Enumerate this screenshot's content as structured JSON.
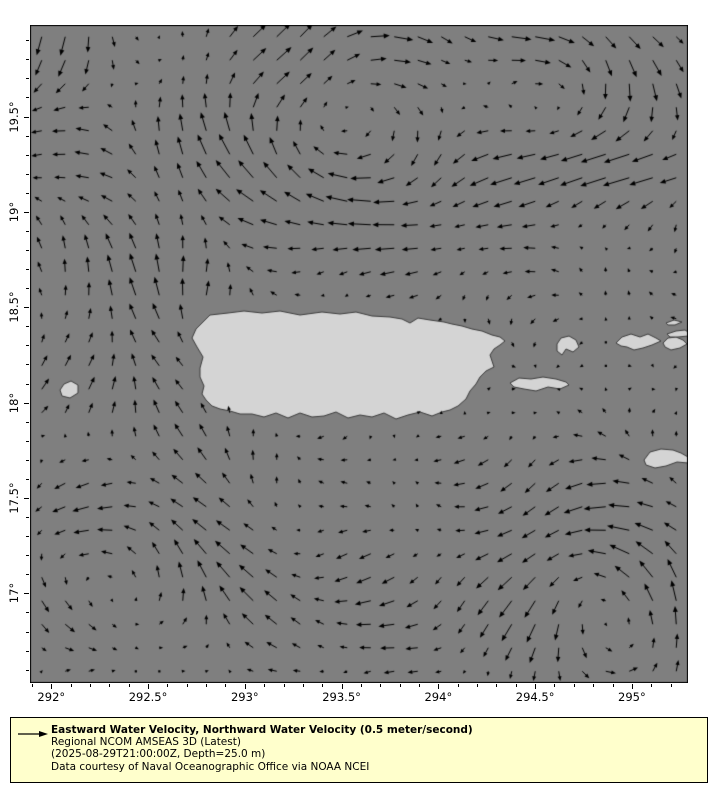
{
  "figure": {
    "width": 720,
    "height": 800,
    "background": "#ffffff"
  },
  "map": {
    "ocean_color": "#7f7f7f",
    "land_color": "#d4d4d4",
    "coast_color": "#3c3c3c",
    "arrow_color": "#000000",
    "frame_color": "#000000",
    "frame": {
      "left": 30,
      "top": 25,
      "width": 658,
      "height": 658
    },
    "lon_min": 291.89,
    "lon_max": 295.29,
    "lat_min": 16.53,
    "lat_max": 19.98,
    "islands": [
      {
        "name": "puerto-rico",
        "px": [
          [
            192,
            338
          ],
          [
            196,
            329
          ],
          [
            210,
            315
          ],
          [
            228,
            313
          ],
          [
            244,
            311
          ],
          [
            262,
            313
          ],
          [
            280,
            311
          ],
          [
            300,
            315
          ],
          [
            322,
            312
          ],
          [
            340,
            314
          ],
          [
            356,
            312
          ],
          [
            372,
            316
          ],
          [
            390,
            317
          ],
          [
            402,
            319
          ],
          [
            410,
            323
          ],
          [
            418,
            318
          ],
          [
            430,
            320
          ],
          [
            444,
            322
          ],
          [
            452,
            324
          ],
          [
            462,
            326
          ],
          [
            472,
            329
          ],
          [
            482,
            331
          ],
          [
            492,
            335
          ],
          [
            500,
            337
          ],
          [
            505,
            341
          ],
          [
            500,
            345
          ],
          [
            494,
            349
          ],
          [
            490,
            355
          ],
          [
            492,
            361
          ],
          [
            494,
            367
          ],
          [
            486,
            371
          ],
          [
            480,
            377
          ],
          [
            476,
            384
          ],
          [
            470,
            391
          ],
          [
            466,
            399
          ],
          [
            458,
            406
          ],
          [
            450,
            410
          ],
          [
            442,
            412
          ],
          [
            432,
            416
          ],
          [
            420,
            412
          ],
          [
            408,
            415
          ],
          [
            396,
            419
          ],
          [
            384,
            413
          ],
          [
            372,
            417
          ],
          [
            360,
            415
          ],
          [
            348,
            418
          ],
          [
            336,
            412
          ],
          [
            324,
            416
          ],
          [
            312,
            417
          ],
          [
            300,
            413
          ],
          [
            288,
            418
          ],
          [
            276,
            413
          ],
          [
            264,
            417
          ],
          [
            252,
            414
          ],
          [
            240,
            414
          ],
          [
            230,
            411
          ],
          [
            220,
            409
          ],
          [
            212,
            406
          ],
          [
            206,
            400
          ],
          [
            202,
            394
          ],
          [
            204,
            386
          ],
          [
            200,
            377
          ],
          [
            200,
            368
          ],
          [
            203,
            357
          ],
          [
            197,
            347
          ]
        ]
      },
      {
        "name": "mona-island",
        "px": [
          [
            60,
            390
          ],
          [
            64,
            384
          ],
          [
            71,
            381
          ],
          [
            78,
            385
          ],
          [
            78,
            393
          ],
          [
            70,
            398
          ],
          [
            62,
            396
          ]
        ]
      },
      {
        "name": "vieques",
        "px": [
          [
            510,
            383
          ],
          [
            519,
            378
          ],
          [
            531,
            379
          ],
          [
            543,
            377
          ],
          [
            556,
            379
          ],
          [
            566,
            382
          ],
          [
            569,
            385
          ],
          [
            560,
            389
          ],
          [
            548,
            387
          ],
          [
            536,
            391
          ],
          [
            524,
            389
          ],
          [
            514,
            387
          ]
        ]
      },
      {
        "name": "culebra",
        "px": [
          [
            557,
            344
          ],
          [
            561,
            338
          ],
          [
            569,
            336
          ],
          [
            576,
            340
          ],
          [
            579,
            347
          ],
          [
            573,
            352
          ],
          [
            566,
            349
          ],
          [
            562,
            355
          ],
          [
            557,
            351
          ]
        ]
      },
      {
        "name": "st-thomas",
        "px": [
          [
            616,
            343
          ],
          [
            622,
            337
          ],
          [
            631,
            334
          ],
          [
            640,
            337
          ],
          [
            648,
            334
          ],
          [
            656,
            338
          ],
          [
            661,
            341
          ],
          [
            652,
            345
          ],
          [
            643,
            348
          ],
          [
            634,
            350
          ],
          [
            627,
            347
          ],
          [
            621,
            346
          ]
        ]
      },
      {
        "name": "st-john",
        "px": [
          [
            663,
            343
          ],
          [
            668,
            338
          ],
          [
            676,
            337
          ],
          [
            683,
            340
          ],
          [
            687,
            344
          ],
          [
            680,
            348
          ],
          [
            671,
            350
          ],
          [
            665,
            347
          ]
        ]
      },
      {
        "name": "tortola",
        "px": [
          [
            667,
            334
          ],
          [
            676,
            331
          ],
          [
            685,
            330
          ],
          [
            688,
            332
          ],
          [
            688,
            336
          ],
          [
            678,
            337
          ],
          [
            670,
            337
          ]
        ]
      },
      {
        "name": "jost-islets",
        "px": [
          [
            666,
            323
          ],
          [
            674,
            320
          ],
          [
            682,
            322
          ],
          [
            675,
            325
          ],
          [
            668,
            325
          ]
        ]
      },
      {
        "name": "st-croix",
        "px": [
          [
            644,
            460
          ],
          [
            650,
            452
          ],
          [
            661,
            449
          ],
          [
            673,
            450
          ],
          [
            681,
            453
          ],
          [
            688,
            457
          ],
          [
            688,
            463
          ],
          [
            677,
            462
          ],
          [
            666,
            466
          ],
          [
            655,
            468
          ],
          [
            646,
            465
          ]
        ]
      }
    ]
  },
  "axes": {
    "x": {
      "major": [
        {
          "value": 292.0,
          "label": "292°"
        },
        {
          "value": 292.5,
          "label": "292.5°"
        },
        {
          "value": 293.0,
          "label": "293°"
        },
        {
          "value": 293.5,
          "label": "293.5°"
        },
        {
          "value": 294.0,
          "label": "294°"
        },
        {
          "value": 294.5,
          "label": "294.5°"
        },
        {
          "value": 295.0,
          "label": "295°"
        }
      ],
      "minor_step": 0.1,
      "major_tick_len": 5,
      "minor_tick_len": 3
    },
    "y": {
      "major": [
        {
          "value": 17.0,
          "label": "17°"
        },
        {
          "value": 17.5,
          "label": "17.5°"
        },
        {
          "value": 18.0,
          "label": "18°"
        },
        {
          "value": 18.5,
          "label": "18.5°"
        },
        {
          "value": 19.0,
          "label": "19°"
        },
        {
          "value": 19.5,
          "label": "19.5°"
        }
      ],
      "minor_step": 0.1,
      "major_tick_len": 5,
      "minor_tick_len": 3
    }
  },
  "chart_data": {
    "type": "quiver-map",
    "title": "Eastward Water Velocity, Northward Water Velocity (0.5 meter/second)",
    "units": "meter/second",
    "reference_speed": 0.5,
    "grid": {
      "cols": 28,
      "rows": 28
    },
    "px_per_mps": 50,
    "max_speed": 0.55,
    "gyres": [
      {
        "name": "north-central-clockwise-gyre",
        "lon": 293.52,
        "lat": 19.5,
        "radius": 0.45,
        "strength": -0.38
      },
      {
        "name": "northeast-clockwise-gyre",
        "lon": 294.55,
        "lat": 19.58,
        "radius": 0.38,
        "strength": -0.3
      },
      {
        "name": "southwest-cyclonic-gyre",
        "lon": 292.33,
        "lat": 17.18,
        "radius": 0.4,
        "strength": 0.26
      },
      {
        "name": "southeast-cyclonic-gyre",
        "lon": 294.85,
        "lat": 16.88,
        "radius": 0.45,
        "strength": 0.3
      },
      {
        "name": "west-edge-cyclonic-gyre",
        "lon": 291.7,
        "lat": 18.55,
        "radius": 0.55,
        "strength": 0.28
      }
    ],
    "blobs": [
      {
        "name": "northwest-southward-flow",
        "lon": 292.05,
        "lat": 19.85,
        "slon": 0.45,
        "slat": 0.35,
        "du": -0.05,
        "dv": -0.3
      },
      {
        "name": "caribbean-westward-current",
        "lon": 293.3,
        "lat": 16.9,
        "slon": 1.7,
        "slat": 0.75,
        "du": -0.22,
        "dv": 0.02
      },
      {
        "name": "south-coast-countercurrent",
        "lon": 293.9,
        "lat": 17.93,
        "slon": 0.55,
        "slat": 0.1,
        "du": 0.14,
        "dv": 0.02
      },
      {
        "name": "mona-passage-flow",
        "lon": 292.45,
        "lat": 18.25,
        "slon": 0.3,
        "slat": 0.45,
        "du": -0.08,
        "dv": 0.12
      },
      {
        "name": "northeast-westward-jet",
        "lon": 295.0,
        "lat": 19.22,
        "slon": 0.55,
        "slat": 0.16,
        "du": -0.35,
        "dv": 0.0
      }
    ],
    "noise": {
      "u": [
        [
          0.07,
          9.1,
          3.1,
          0.0
        ],
        [
          0.05,
          2.0,
          6.3,
          2.1
        ]
      ],
      "v": [
        [
          0.07,
          2.7,
          8.2,
          1.3
        ],
        [
          0.05,
          5.9,
          1.1,
          0.6
        ]
      ]
    }
  },
  "legend": {
    "background": "#ffffcc",
    "border_color": "#000000",
    "arrow_icon": "reference-velocity-arrow",
    "title": "Eastward Water Velocity, Northward Water Velocity (0.5 meter/second)",
    "line2": "Regional NCOM AMSEAS 3D (Latest)",
    "line3": "(2025-08-29T21:00:00Z, Depth=25.0 m)",
    "line4": "Data courtesy of Naval Oceanographic Office via NOAA NCEI"
  }
}
